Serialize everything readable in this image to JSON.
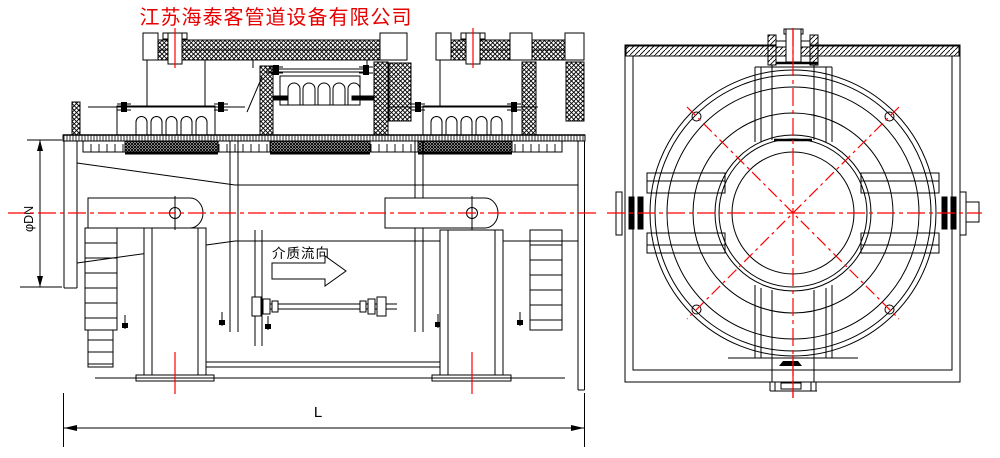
{
  "title": {
    "text": "江苏海泰客管道设备有限公司",
    "color": "#e60000"
  },
  "labels": {
    "flow_direction": "介质流向",
    "dim_diameter": "φDN",
    "dim_length": "L"
  },
  "colors": {
    "centerline_red": "#ff0000",
    "drawing_black": "#000000",
    "background": "#ffffff"
  },
  "end_view": {
    "bolt_hole_count": 4
  }
}
